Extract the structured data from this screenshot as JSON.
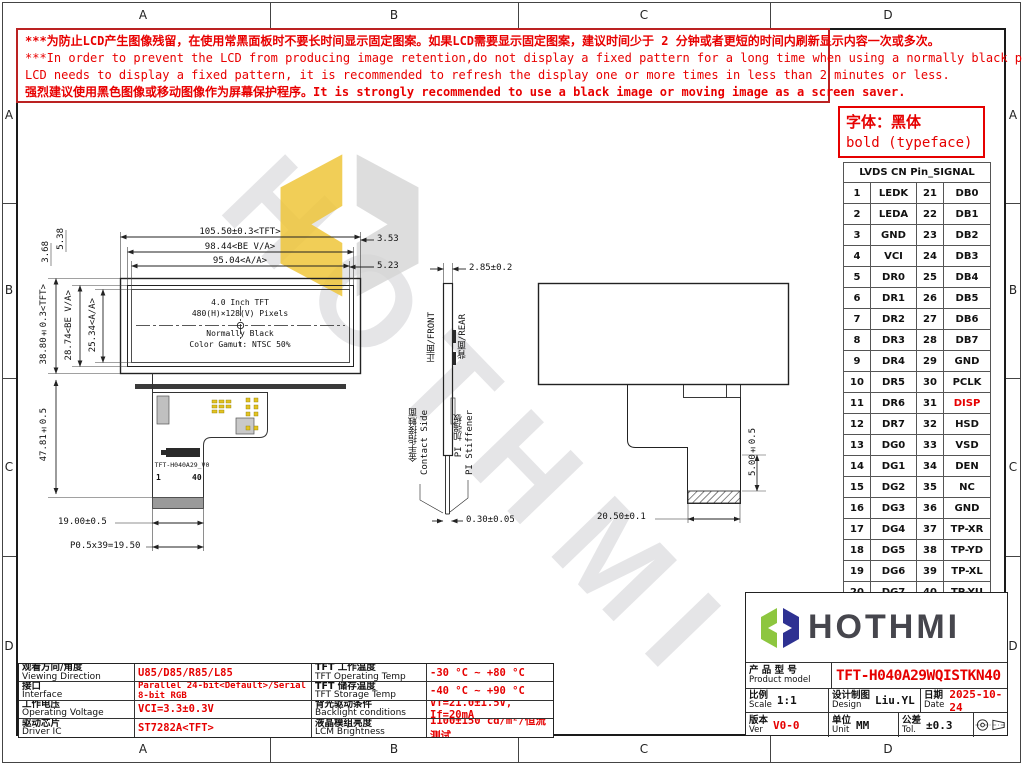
{
  "colors": {
    "accent_red": "#e60000",
    "line": "#222222",
    "logo_green": "#8dc63f",
    "logo_navy": "#2e3192",
    "watermark_yellow": "#eec63a",
    "watermark_gray": "#d4d4d4"
  },
  "frame": {
    "cols": [
      "A",
      "B",
      "C",
      "D"
    ],
    "rows": [
      "A",
      "B",
      "C",
      "D"
    ]
  },
  "warning": {
    "line1": "***为防止LCD产生图像残留，在使用常黑面板时不要长时间显示固定图案。如果LCD需要显示固定图案，建议时间少于 2 分钟或者更短的时间内刷新显示内容一次或多次。",
    "line2": "***In order to prevent the LCD from producing image retention,do not display a fixed pattern for a long time when using a normally black panel.If the",
    "line3": "LCD needs to display a fixed pattern, it is recommended to refresh the display one or more times in less than 2 minutes or less.",
    "line4": "强烈建议使用黑色图像或移动图像作为屏幕保护程序。It is strongly recommended to use a black image or moving image as a screen saver."
  },
  "font_note": {
    "line1": "字体：黑体",
    "line2": "bold (typeface)"
  },
  "pin_table": {
    "title": "LVDS CN Pin_SIGNAL",
    "rows": [
      [
        "1",
        "LEDK",
        "21",
        "DB0"
      ],
      [
        "2",
        "LEDA",
        "22",
        "DB1"
      ],
      [
        "3",
        "GND",
        "23",
        "DB2"
      ],
      [
        "4",
        "VCI",
        "24",
        "DB3"
      ],
      [
        "5",
        "DR0",
        "25",
        "DB4"
      ],
      [
        "6",
        "DR1",
        "26",
        "DB5"
      ],
      [
        "7",
        "DR2",
        "27",
        "DB6"
      ],
      [
        "8",
        "DR3",
        "28",
        "DB7"
      ],
      [
        "9",
        "DR4",
        "29",
        "GND"
      ],
      [
        "10",
        "DR5",
        "30",
        "PCLK"
      ],
      [
        "11",
        "DR6",
        "31",
        "DISP"
      ],
      [
        "12",
        "DR7",
        "32",
        "HSD"
      ],
      [
        "13",
        "DG0",
        "33",
        "VSD"
      ],
      [
        "14",
        "DG1",
        "34",
        "DEN"
      ],
      [
        "15",
        "DG2",
        "35",
        "NC"
      ],
      [
        "16",
        "DG3",
        "36",
        "GND"
      ],
      [
        "17",
        "DG4",
        "37",
        "TP-XR"
      ],
      [
        "18",
        "DG5",
        "38",
        "TP-YD"
      ],
      [
        "19",
        "DG6",
        "39",
        "TP-XL"
      ],
      [
        "20",
        "DG7",
        "40",
        "TP-YU"
      ]
    ]
  },
  "drawing": {
    "front": {
      "dim_width_tft": "105.50±0.3<TFT>",
      "dim_width_be": "98.44<BE V/A>",
      "dim_width_aa": "95.04<A/A>",
      "dim_353": "3.53",
      "dim_523": "5.23",
      "dim_h_tft": "38.80±0.3<TFT>",
      "dim_h_be": "28.74<BE V/A>",
      "dim_h_aa": "25.34<A/A>",
      "dim_538": "5.38",
      "dim_368": "3.68",
      "dim_tail_len": "47.81±0.5",
      "dim_tail_w": "19.00±0.5",
      "dim_pitch": "P0.5x39=19.50",
      "panel_line1": "4.0 Inch TFT",
      "panel_line2": "480(H)×128(V) Pixels",
      "panel_line3": "Normally Black",
      "panel_line4": "Color Gamut: NTSC 50%",
      "fpc_label": "TFT-H040A29_V0",
      "pin1": "1",
      "pin40": "40"
    },
    "side": {
      "dim_thk": "2.85±0.2",
      "front_label": "正面/FRONT",
      "rear_label": "背面/REAR",
      "contact_zh": "金手指接触面",
      "contact_en": "Contact Side",
      "stiffener_zh": "PI 加强板",
      "stiffener_en": "PI Stiffener",
      "dim_contact_thk": "0.30±0.05"
    },
    "rear": {
      "dim_tail_drop": "5.00±0.5",
      "dim_tail_offset": "20.50±0.1"
    }
  },
  "specs": {
    "rows": [
      {
        "zh1": "观看方向/角度",
        "en1": "Viewing Direction",
        "v1": "U85/D85/R85/L85",
        "zh2": "TFT 工作温度",
        "en2": "TFT Operating Temp",
        "v2": "-30 °C ~ +80 °C"
      },
      {
        "zh1": "接口",
        "en1": "Interface",
        "v1": "Parallel 24-bit<Default>/Serial 8-bit RGB",
        "zh2": "TFT 储存温度",
        "en2": "TFT Storage Temp",
        "v2": "-40 °C ~ +90 °C"
      },
      {
        "zh1": "工作电压",
        "en1": "Operating Voltage",
        "v1": "VCI=3.3±0.3V",
        "zh2": "背光驱动条件",
        "en2": "Backlight conditions",
        "v2": "Vf=21.0±1.5V, If=20mA"
      },
      {
        "zh1": "驱动芯片",
        "en1": "Driver IC",
        "v1": "ST7282A<TFT>",
        "zh2": "液晶模组亮度",
        "en2": "LCM Brightness",
        "v2": "1100±150 cd/m²/恒流测试"
      }
    ]
  },
  "title_block": {
    "logo_text": "HOTHMI",
    "product_label_zh": "产 品 型 号",
    "product_label_en": "Product model",
    "product_value": "TFT-H040A29WQISTKN40",
    "scale_zh": "比例",
    "scale_en": "Scale",
    "scale_value": "1:1",
    "design_zh": "设计制图",
    "design_en": "Design",
    "design_value": "Liu.YL",
    "date_zh": "日期",
    "date_en": "Date",
    "date_value": "2025-10-24",
    "ver_zh": "版本",
    "ver_en": "Ver",
    "ver_value": "V0-0",
    "unit_zh": "单位",
    "unit_en": "Unit",
    "unit_value": "MM",
    "tol_zh": "公差",
    "tol_en": "Tol.",
    "tol_value": "±0.3"
  },
  "watermark": {
    "text": "HOTHMI"
  }
}
